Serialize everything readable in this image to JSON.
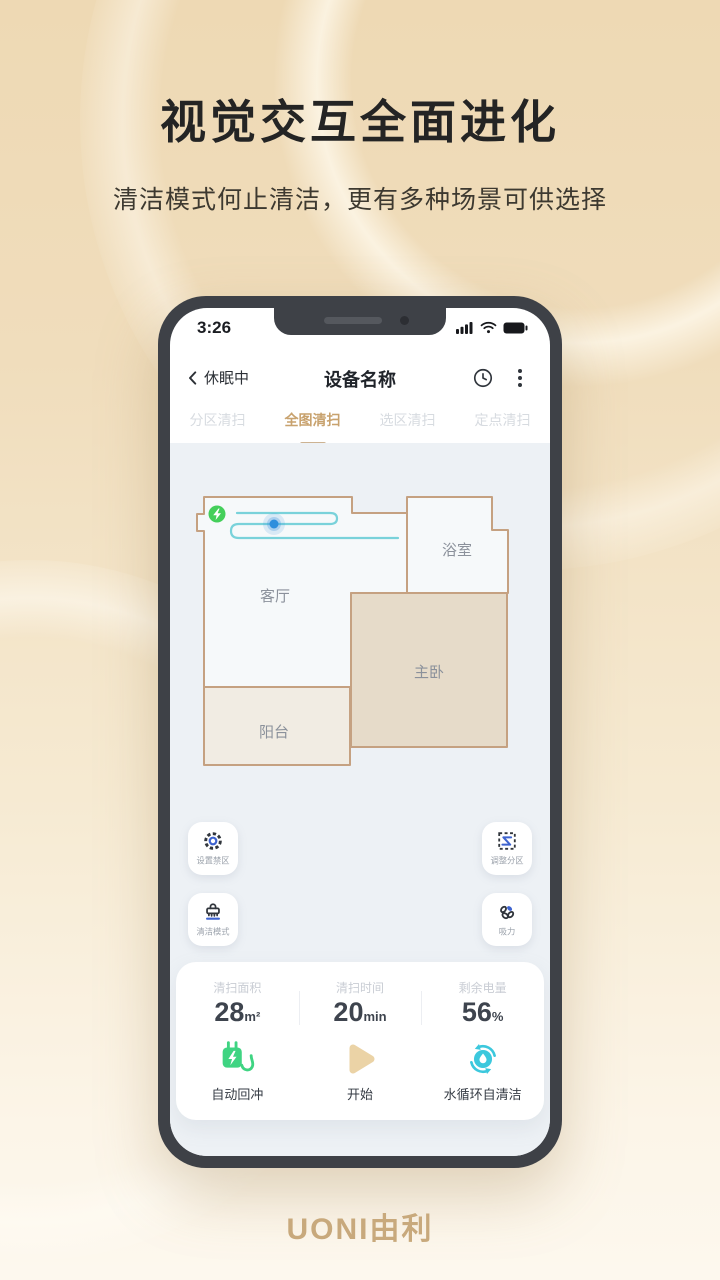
{
  "hero": {
    "title": "视觉交互全面进化",
    "subtitle": "清洁模式何止清洁，更有多种场景可供选择"
  },
  "phone": {
    "status_bar": {
      "time": "3:26"
    },
    "nav": {
      "back_label": "休眠中",
      "title": "设备名称"
    },
    "tabs": [
      {
        "label": "分区清扫",
        "active": false
      },
      {
        "label": "全图清扫",
        "active": true
      },
      {
        "label": "选区清扫",
        "active": false
      },
      {
        "label": "定点清扫",
        "active": false
      }
    ],
    "map": {
      "rooms": [
        {
          "name": "客厅"
        },
        {
          "name": "浴室"
        },
        {
          "name": "主卧"
        },
        {
          "name": "阳台"
        }
      ]
    },
    "map_buttons": [
      {
        "label": "设置禁区",
        "icon": "gear-icon"
      },
      {
        "label": "调整分区",
        "icon": "partition-icon"
      },
      {
        "label": "清洁模式",
        "icon": "brush-icon"
      },
      {
        "label": "吸力",
        "icon": "fan-icon"
      }
    ],
    "stats": [
      {
        "label": "清扫面积",
        "value": "28",
        "unit": "m²"
      },
      {
        "label": "清扫时间",
        "value": "20",
        "unit": "min"
      },
      {
        "label": "剩余电量",
        "value": "56",
        "unit": "%"
      }
    ],
    "actions": [
      {
        "label": "自动回冲",
        "icon": "recharge-plug-icon"
      },
      {
        "label": "开始",
        "icon": "play-icon"
      },
      {
        "label": "水循环自清洁",
        "icon": "water-selfclean-icon"
      }
    ]
  },
  "footer": {
    "logo": "UONI由利"
  },
  "colors": {
    "accent_gold": "#c8a26e",
    "page_beige": "#eed9b4",
    "map_bg": "#edf1f5",
    "wall": "#c5a181",
    "room_fill": "#f6f9fa",
    "bedroom_fill": "#e6dbc9",
    "balcony_fill": "#f1ece3",
    "path_teal": "#79d2da",
    "robot_blue": "#2f8fdd",
    "dock_green": "#44cf5a",
    "icon_green": "#3fd482",
    "icon_cyan": "#3cc8dd",
    "icon_blue": "#3e63cf",
    "play_tan": "#ebd3a6"
  }
}
